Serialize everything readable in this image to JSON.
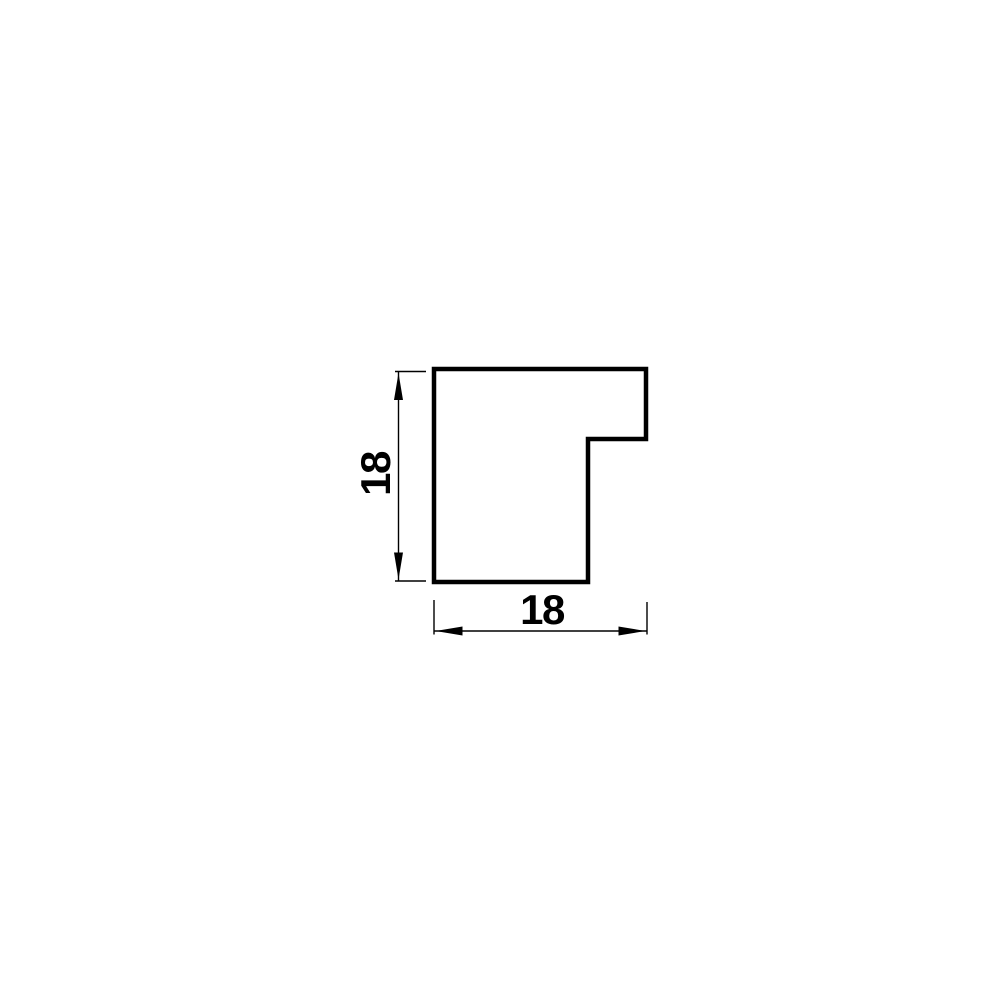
{
  "page": {
    "background_color": "#ffffff"
  },
  "drawing": {
    "description": "Technical cross-section drawing of a rebated square picture-frame moulding profile",
    "line_color": "#000000",
    "profile": {
      "path_d": "M 434 369 L 646 369 L 646 439 L 588 439 L 588 582 L 434 582 Z",
      "stroke_width": 4.5,
      "fill": "#ffffff"
    },
    "dimensions": {
      "height": {
        "label": "18",
        "orientation": "vertical"
      },
      "width": {
        "label": "18",
        "orientation": "horizontal"
      }
    }
  }
}
